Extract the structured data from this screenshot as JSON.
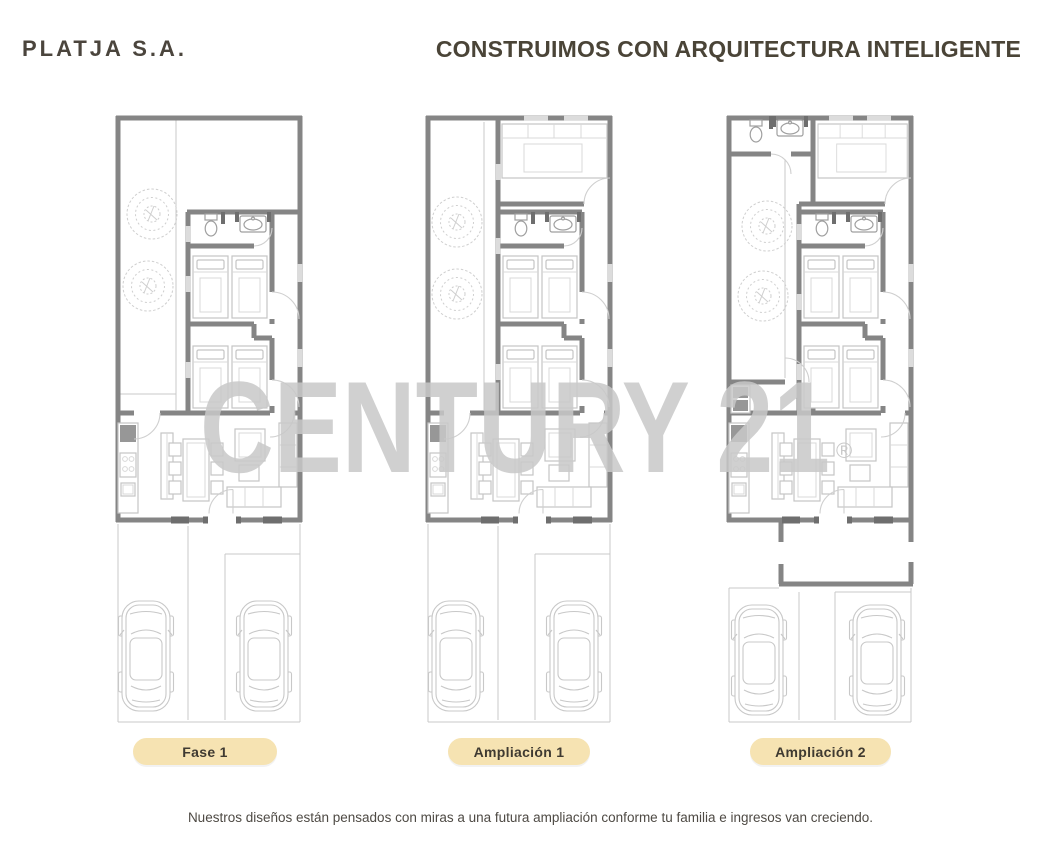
{
  "brand": {
    "logo_text": "PLATJA S.A."
  },
  "header": {
    "headline": "CONSTRUIMOS CON ARQUITECTURA INTELIGENTE"
  },
  "watermark": {
    "text": "CENTURY 21",
    "registered": "®"
  },
  "plans": [
    {
      "name": "fase-1",
      "label": "Fase 1"
    },
    {
      "name": "ampliacion-1",
      "label": "Ampliación 1"
    },
    {
      "name": "ampliacion-2",
      "label": "Ampliación 2"
    }
  ],
  "footer": {
    "caption": "Nuestros diseños están pensados con miras a una futura ampliación conforme tu familia e ingresos van creciendo."
  },
  "colors": {
    "logo": "#4b453d",
    "headline": "#4a4437",
    "badge_bg": "#f6e3b2",
    "badge_text": "#3f3a31",
    "watermark": "#c8c8c8",
    "wall": "#858585",
    "furniture": "#c5c5c5",
    "background": "#ffffff"
  }
}
